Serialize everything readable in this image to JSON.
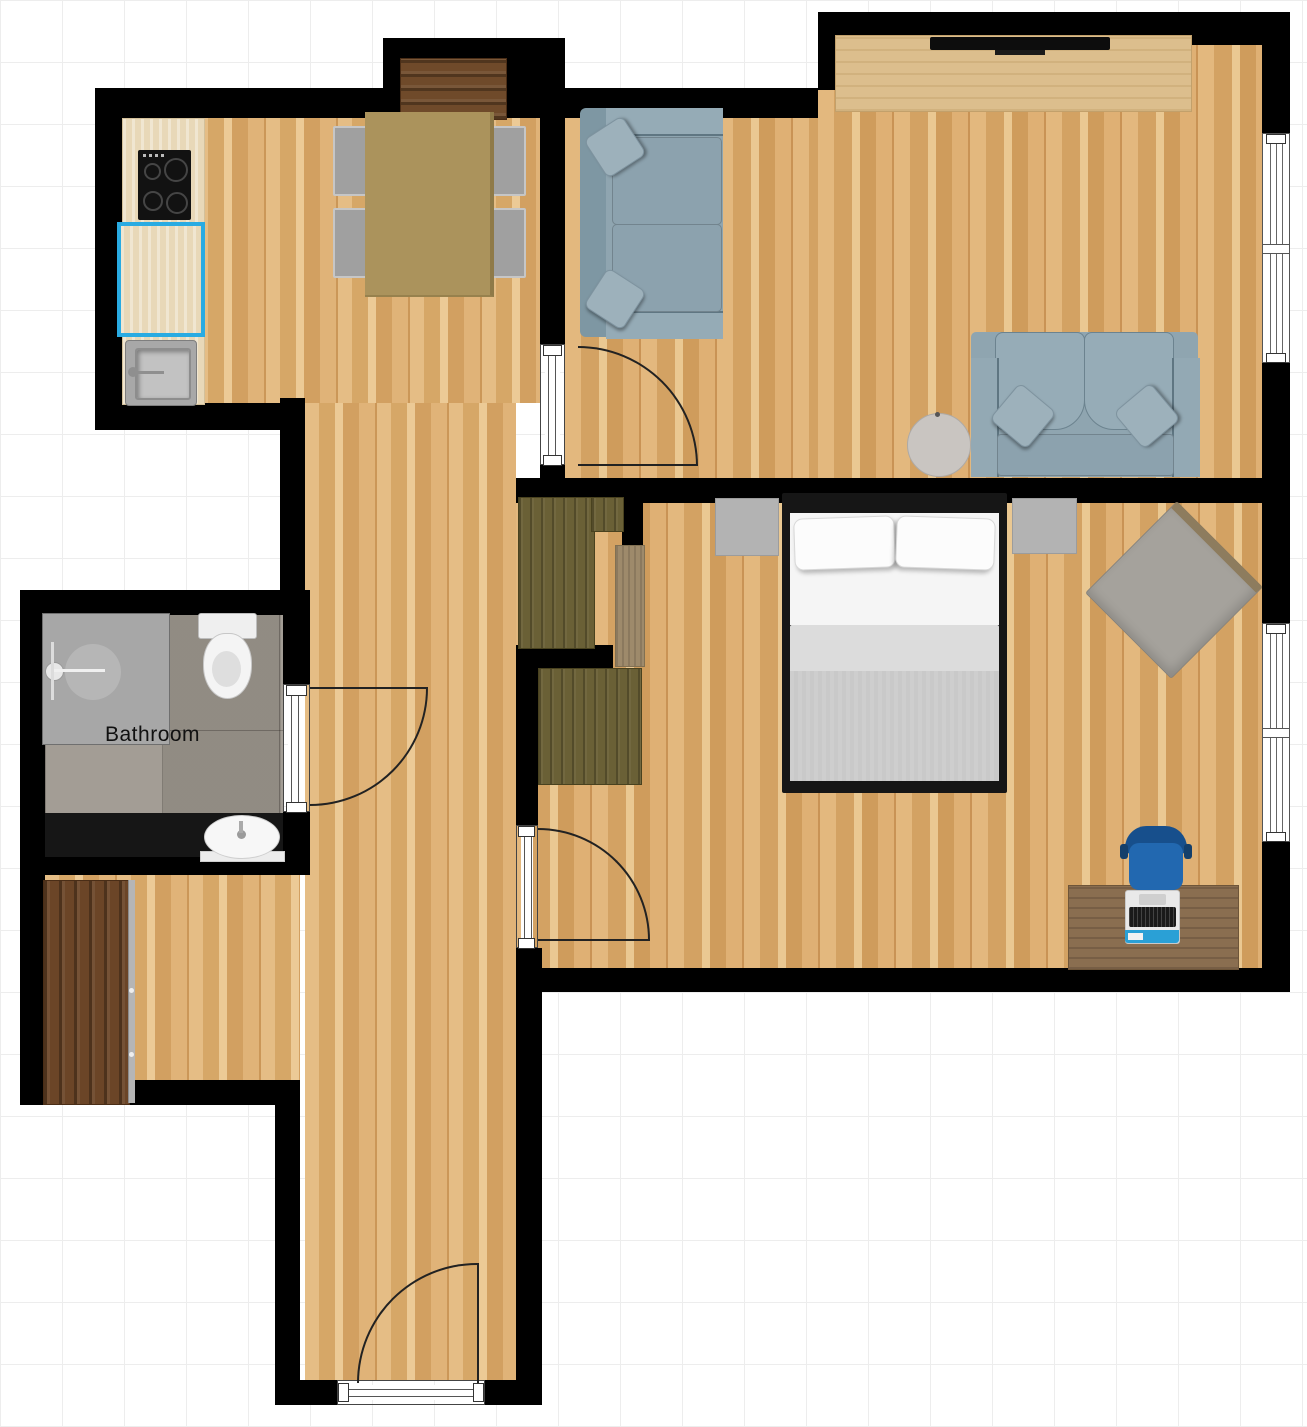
{
  "labels": {
    "bathroom": "Bathroom"
  },
  "palette": {
    "wall": "#000000",
    "selection_accent": "#29abe2",
    "wood_floor": "#deb177",
    "bathroom_tile": "#9c968d",
    "sofa_blue": "#8fa5b0",
    "office_chair_blue": "#2268b0",
    "laptop_sticker_blue": "#2aa0d6",
    "wardrobe_olive": "#6a6036",
    "walnut_wood": "#6b4527",
    "oak_sideboard": "#dcbe8d",
    "desk_brown": "#8a6e50",
    "dining_table_olive": "#ab935c",
    "fixture_white": "#f4f4f4",
    "nightstand_gray": "#b3b3b3"
  },
  "furniture": [
    "kitchen-counter",
    "cooktop",
    "selected-counter",
    "kitchen-sink",
    "dining-table",
    "dining-chair",
    "niche-sideboard",
    "tv-sideboard",
    "tv",
    "sofa",
    "loveseat",
    "round-side-table",
    "double-bed",
    "nightstand",
    "wardrobe",
    "dresser",
    "accent-armchair",
    "desk",
    "office-chair",
    "laptop",
    "shower",
    "toilet",
    "bathroom-vanity",
    "bathroom-sink",
    "entry-wardrobe"
  ]
}
